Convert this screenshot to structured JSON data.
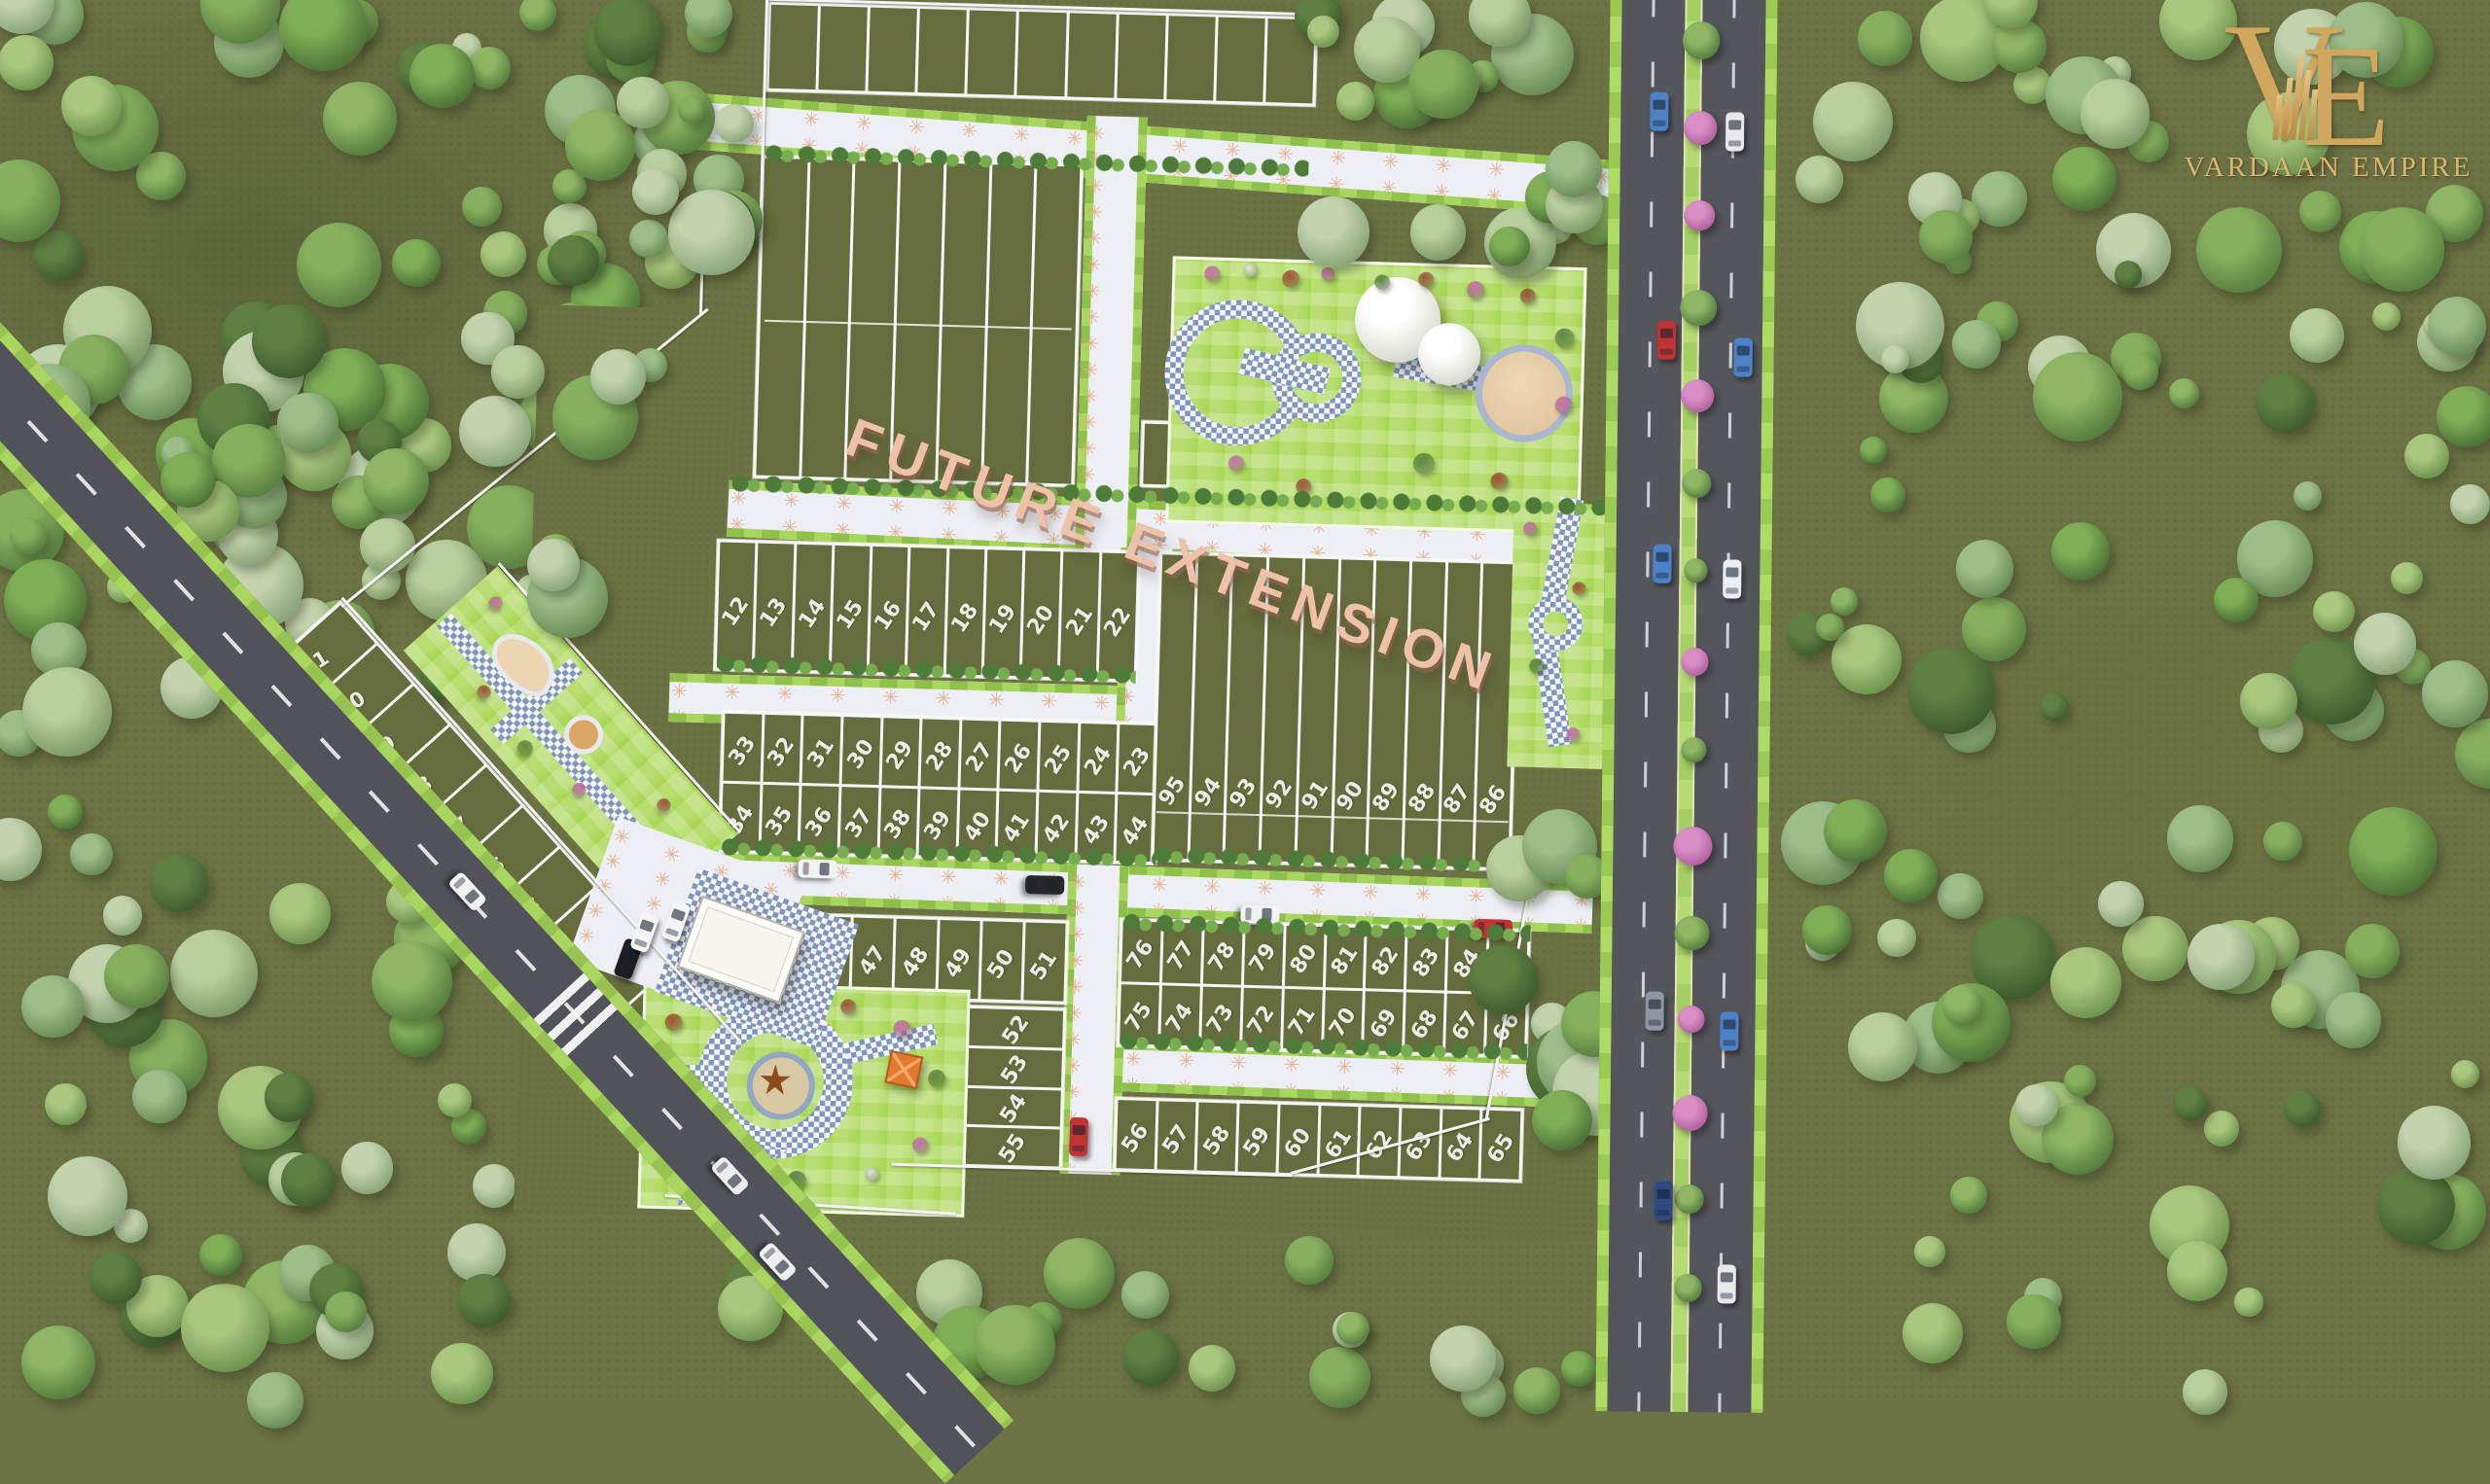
{
  "branding": {
    "monogram_v": "V",
    "monogram_e": "E",
    "company_name": "VARDAAN EMPIRE"
  },
  "labels": {
    "future_extension": "FUTURE EXTENSION"
  },
  "plots": {
    "left_strip": [
      "11",
      "10",
      "9",
      "8",
      "7",
      "6",
      "5",
      "4",
      "3",
      "2",
      "1"
    ],
    "row_12_22": [
      "12",
      "13",
      "14",
      "15",
      "16",
      "17",
      "18",
      "19",
      "20",
      "21",
      "22"
    ],
    "row_33_23": [
      "33",
      "32",
      "31",
      "30",
      "29",
      "28",
      "27",
      "26",
      "25",
      "24",
      "23"
    ],
    "row_34_44": [
      "34",
      "35",
      "36",
      "37",
      "38",
      "39",
      "40",
      "41",
      "42",
      "43",
      "44"
    ],
    "row_45_51": [
      "45",
      "46",
      "47",
      "48",
      "49",
      "50",
      "51"
    ],
    "stack_52_55": [
      "52",
      "53",
      "54",
      "55"
    ],
    "row_56_65": [
      "56",
      "57",
      "58",
      "59",
      "60",
      "61",
      "62",
      "63",
      "64",
      "65"
    ],
    "row_76_85": [
      "76",
      "77",
      "78",
      "79",
      "80",
      "81",
      "82",
      "83",
      "84",
      "85"
    ],
    "row_75_66": [
      "75",
      "74",
      "73",
      "72",
      "71",
      "70",
      "69",
      "68",
      "67",
      "66"
    ],
    "row_95_86": [
      "95",
      "94",
      "93",
      "92",
      "91",
      "90",
      "89",
      "88",
      "87",
      "86"
    ]
  },
  "decor": {
    "flower": "✳"
  },
  "colors": {
    "logo_gold": "#cfa75e",
    "label_salmon": "#eec2a8",
    "road_light": "#edeff5",
    "road_star": "#e3ab83",
    "verge_lime": "#9bca52",
    "asphalt": "#55565c",
    "plot_green": "#656d3e",
    "lawn_green": "#a6d64f",
    "checker_blue": "#8096ba",
    "sand_tan": "#ecd6b2",
    "median_pink": "#c873ae",
    "terrain_olive": "#6c7344"
  },
  "vehicles": {
    "highway": [
      "#4d82c8",
      "#e9e9ec",
      "#c03333",
      "#4d82c8",
      "#4d82c8",
      "#eceff2",
      "#8f97a2",
      "#4d82c8",
      "#2e4a80",
      "#e9e9ec"
    ],
    "site": [
      "#f2f2f2",
      "#26262b",
      "#f2f2f2",
      "#c23434",
      "#c23434",
      "#f2f2f2",
      "#ececec",
      "#1d1d22",
      "#f4f4f4",
      "#f4f4f4",
      "#efefef"
    ]
  }
}
